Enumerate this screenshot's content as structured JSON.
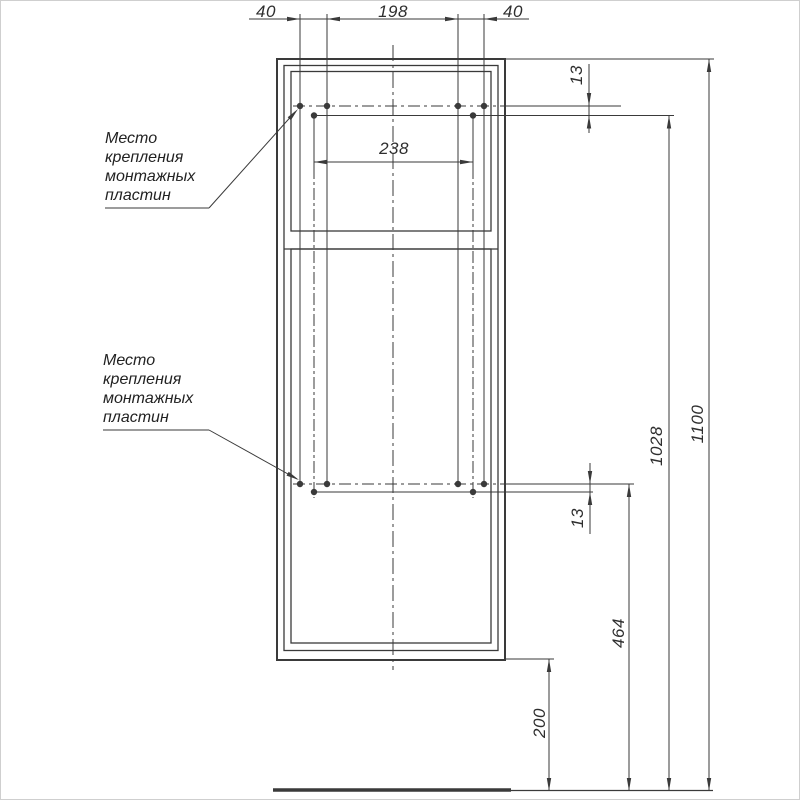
{
  "notes": {
    "mounting_plate_top": {
      "lines": [
        "Место",
        "крепления",
        "монтажных",
        "пластин"
      ]
    },
    "mounting_plate_bottom": {
      "lines": [
        "Место",
        "крепления",
        "монтажных",
        "пластин"
      ]
    }
  },
  "dimensions": {
    "top_left_offset": "40",
    "top_center_span": "198",
    "top_right_offset": "40",
    "plate_holes_span": "238",
    "plate_row_offset_top": "13",
    "plate_row_offset_bottom": "13",
    "height_to_top_plates": "1028",
    "total_height": "1100",
    "height_to_bottom_plates": "464",
    "bottom_clearance": "200"
  },
  "colors": {
    "line": "#3a3a3a",
    "background": "#ffffff"
  }
}
